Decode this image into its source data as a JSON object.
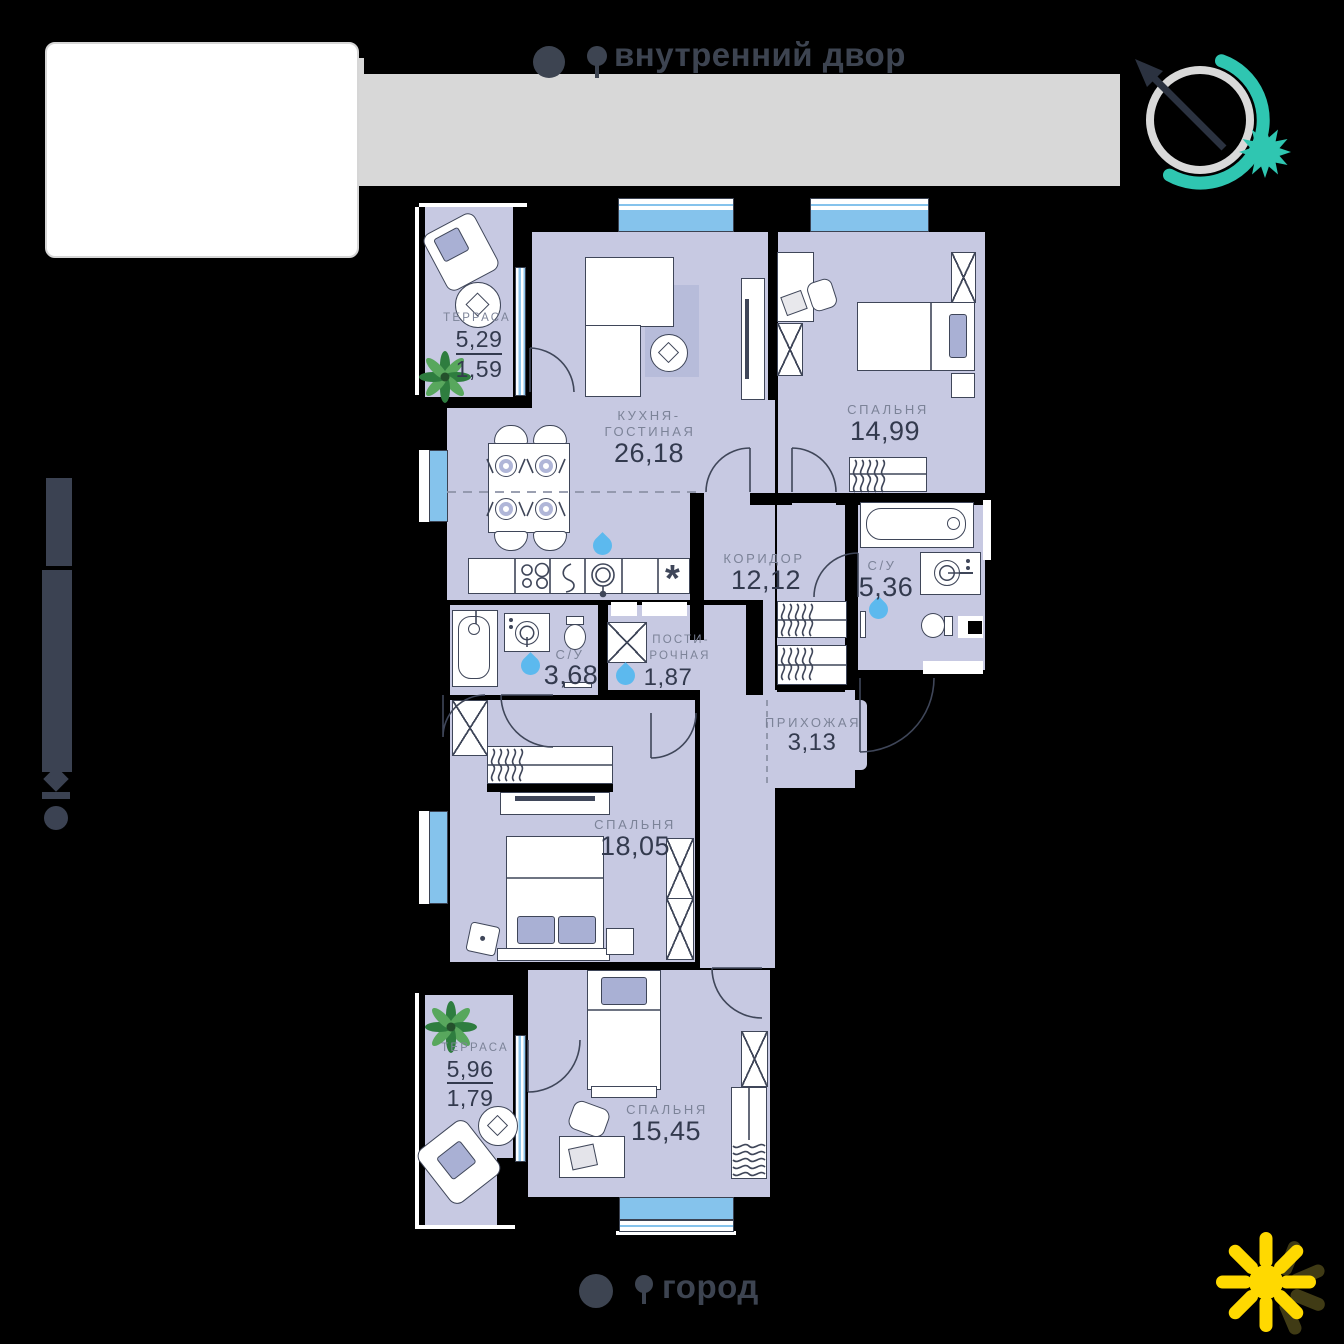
{
  "header": {
    "courtyard_label": "внутренний двор"
  },
  "footer": {
    "city_label": "город"
  },
  "rooms": {
    "terrace_top": {
      "name": "ТЕРРАСА",
      "area_total": "5,29",
      "area_reduced": "1,59"
    },
    "kitchen_living": {
      "name_line1": "КУХНЯ-",
      "name_line2": "ГОСТИНАЯ",
      "area": "26,18"
    },
    "bedroom_1": {
      "name": "СПАЛЬНЯ",
      "area": "14,99"
    },
    "corridor": {
      "name": "КОРИДОР",
      "area": "12,12"
    },
    "bathroom_1": {
      "name": "С/У",
      "area": "5,36"
    },
    "bathroom_2": {
      "name": "С/У",
      "area": "3,68"
    },
    "laundry": {
      "name_line1": "ПОСТИ-",
      "name_line2": "РОЧНАЯ",
      "area": "1,87"
    },
    "hallway": {
      "name": "ПРИХОЖАЯ",
      "area": "3,13"
    },
    "bedroom_2": {
      "name": "СПАЛЬНЯ",
      "area": "18,05"
    },
    "terrace_bottom": {
      "name": "ТЕРРАСА",
      "area_total": "5,96",
      "area_reduced": "1,79"
    },
    "bedroom_3": {
      "name": "СПАЛЬНЯ",
      "area": "15,45"
    }
  },
  "symbols": {
    "fridge": "*"
  },
  "colors": {
    "floor": "#c7c9e2",
    "window_blue": "#85c3ec",
    "teal": "#2fc6b1",
    "sun_yellow": "#ffd900",
    "drop_blue": "#5cb9ee",
    "text_dark": "#333a4e",
    "label_gray": "#7c8398",
    "banner_gray": "#d8d8d8"
  }
}
